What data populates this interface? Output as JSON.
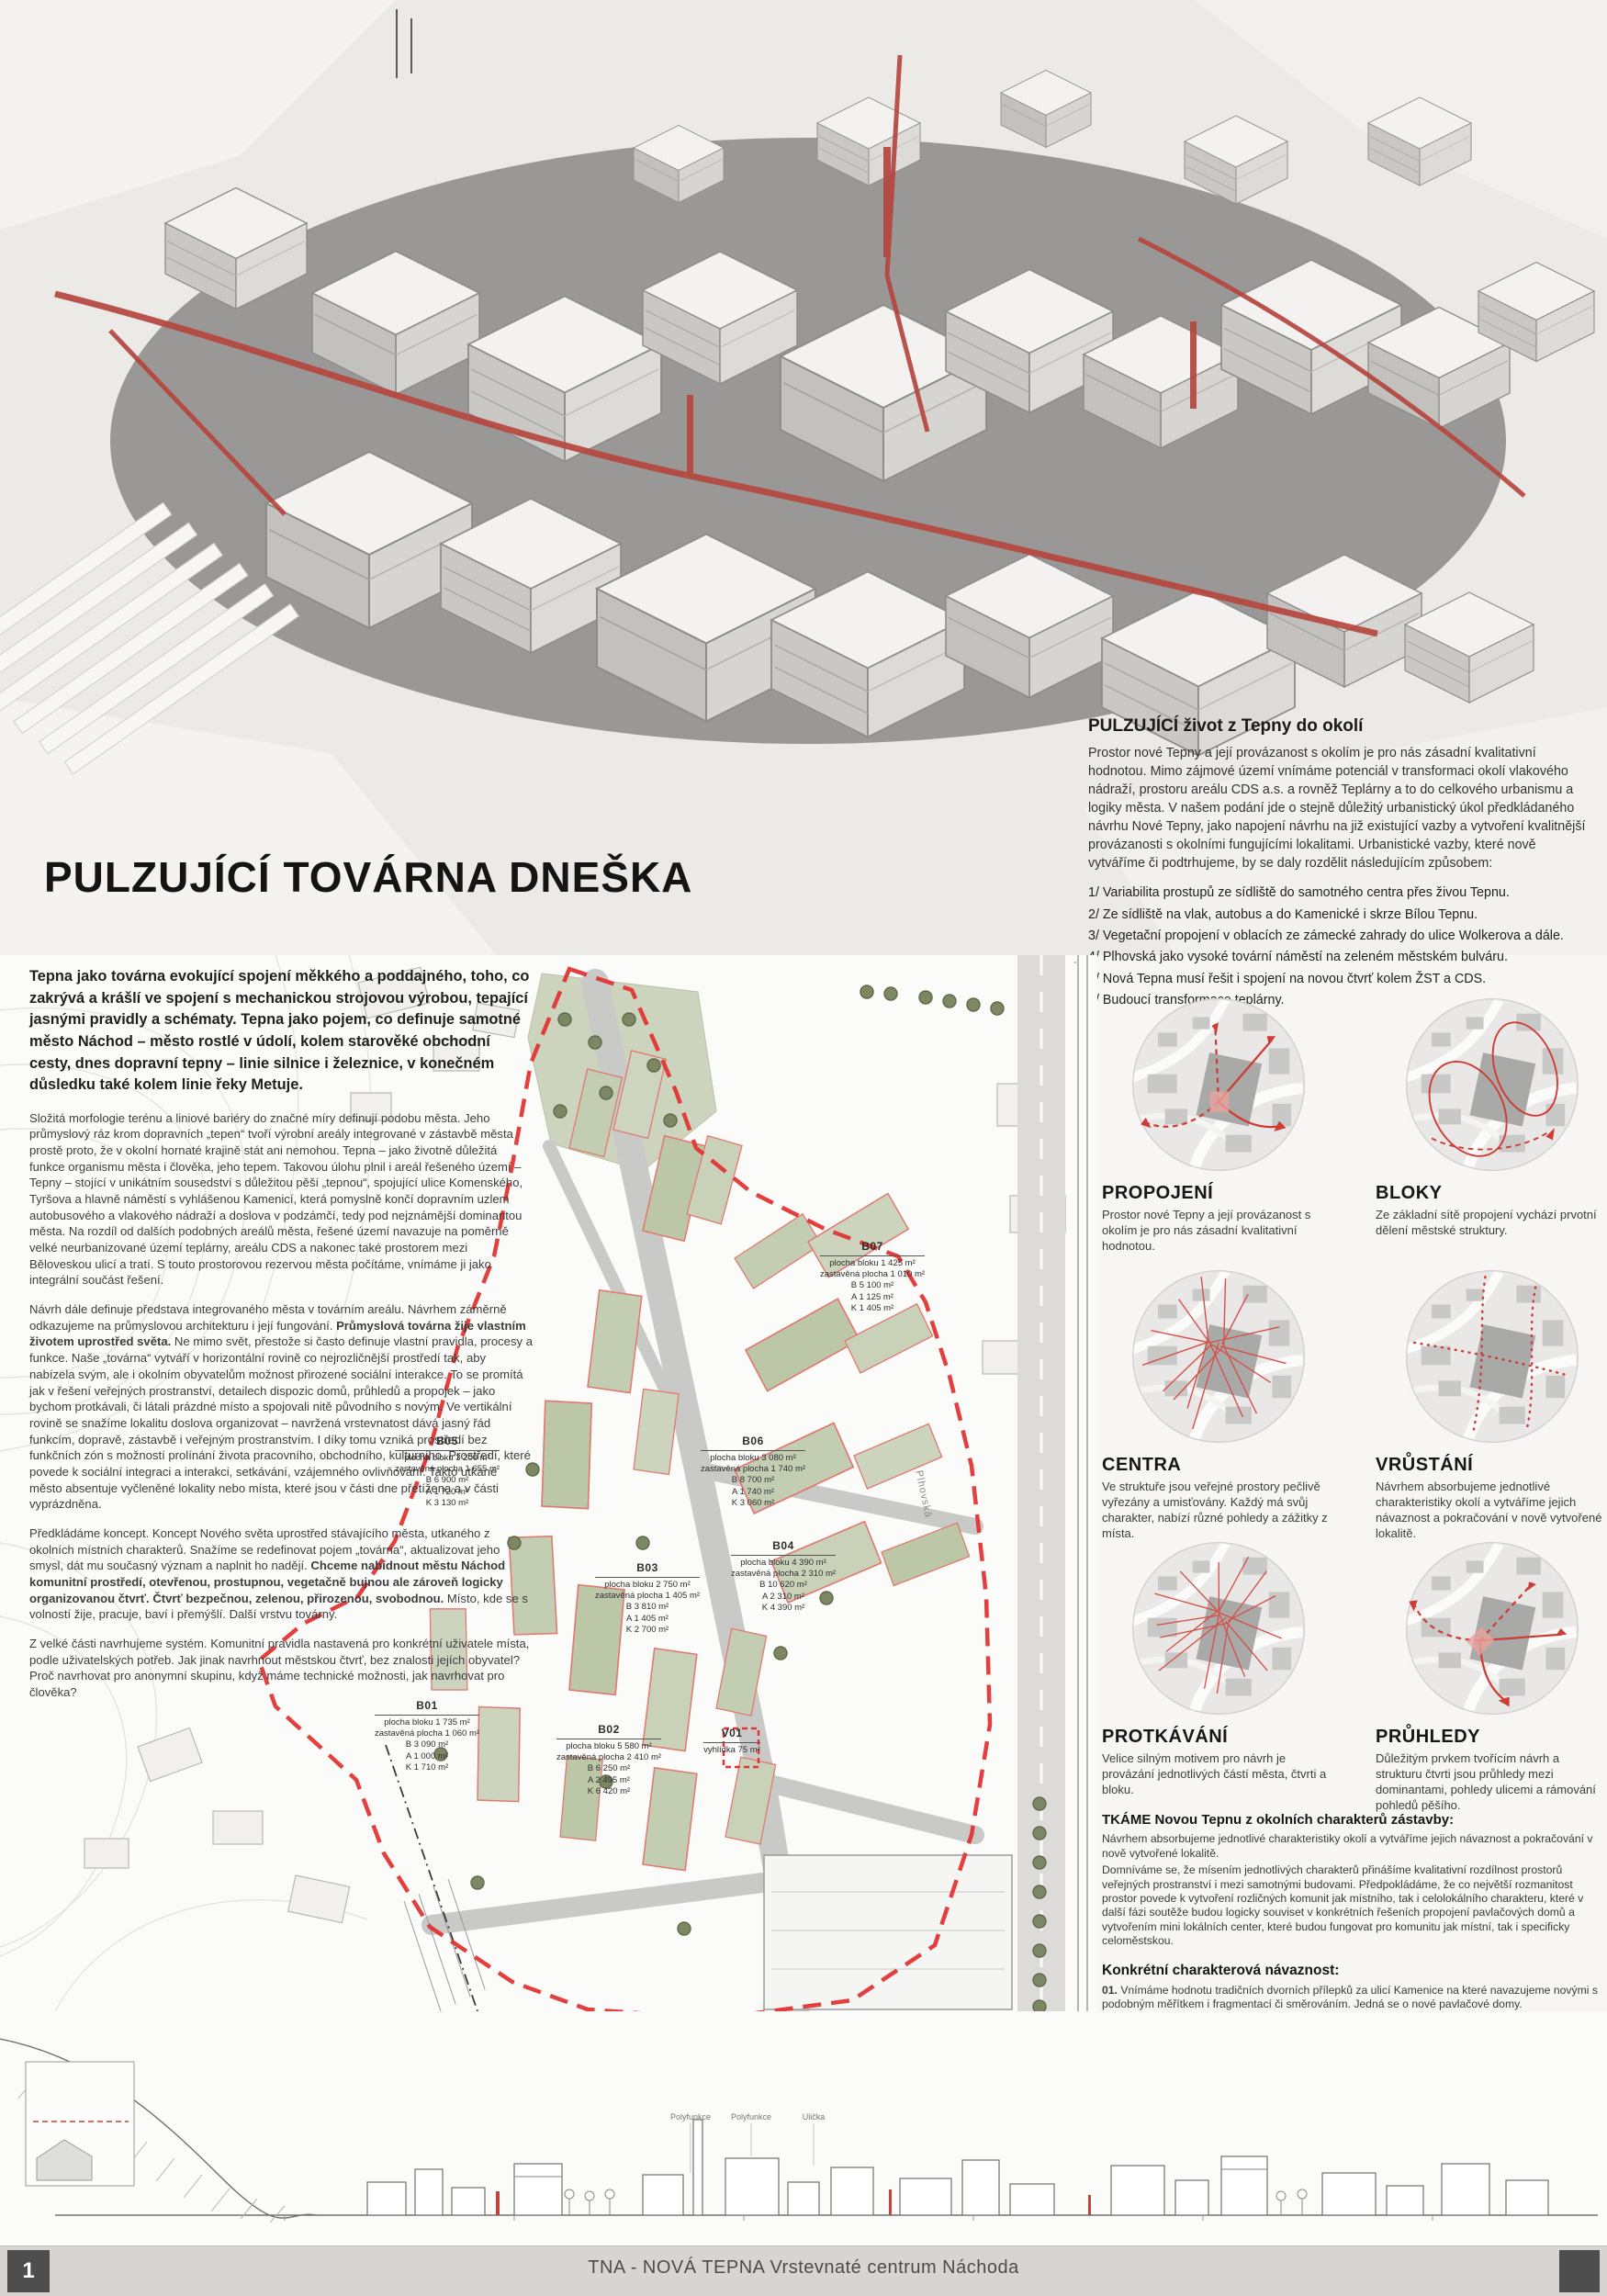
{
  "poster": {
    "title": "PULZUJÍCÍ TOVÁRNA DNEŠKA",
    "page_number": "1",
    "footer": "TNA - NOVÁ TEPNA Vrstevnaté centrum Náchoda"
  },
  "colors": {
    "accent_red": "#b5463f",
    "plan_red": "#e23535",
    "plan_green": "#c3cdb2",
    "footer_gray": "#d6d5d3"
  },
  "hero": {
    "heading": "PULZUJÍCÍ život z Tepny do okolí",
    "body": "Prostor nové Tepny a její provázanost s okolím je pro nás zásadní kvalitativní hodnotou. Mimo zájmové území vnímáme potenciál v transformaci okolí vlakového nádraží, prostoru areálu CDS a.s. a rovněž Teplárny a to do celkového urbanismu a logiky města. V našem podání jde o stejně důležitý urbanistický úkol předkládaného návrhu Nové Tepny, jako napojení návrhu na již existující vazby a vytvoření kvalitnější provázanosti s okolními fungujícími lokalitami. Urbanistické vazby, které nově vytváříme či podtrhujeme, by se daly rozdělit následujícím způsobem:",
    "list": [
      "1/ Variabilita prostupů ze sídliště do samotného centra přes živou Tepnu.",
      "2/ Ze sídliště na vlak, autobus a do Kamenické i skrze Bílou Tepnu.",
      "3/ Vegetační propojení v oblacích ze zámecké zahrady do ulice Wolkerova a dále.",
      "4/ Plhovská jako vysoké tovární náměstí na zeleném městském bulváru.",
      "5/ Nová Tepna musí řešit i spojení na novou čtvrť kolem ŽST a CDS.",
      "6/ Budoucí transformace teplárny."
    ]
  },
  "left_column": {
    "lead": "Tepna jako továrna evokující spojení měkkého a poddajného, toho, co zakrývá a krášlí ve spojení s mechanickou strojovou výrobou, tepající jasnými pravidly a schématy. Tepna jako pojem, co definuje samotné město Náchod – město rostlé v údolí, kolem starověké obchodní cesty, dnes dopravní tepny – linie silnice i železnice, v konečném důsledku také kolem linie řeky Metuje.",
    "p1": "Složitá morfologie terénu a liniové bariéry do značné míry definují podobu města. Jeho průmyslový ráz krom dopravních „tepen“ tvoří výrobní areály integrované v zástavbě města prostě proto, že v okolní hornaté krajině stát ani nemohou. Tepna – jako životně důležitá funkce organismu města i člověka, jeho tepem. Takovou úlohu plnil i areál řešeného území – Tepny – stojící v unikátním sousedství s důležitou pěší „tepnou“, spojující ulice Komenského, Tyršova a hlavně náměstí s vyhlášenou Kamenicí, která pomyslně končí dopravním uzlem autobusového a vlakového nádraží a doslova v podzámčí, tedy pod nejznámější dominantou města. Na rozdíl od dalších podobných areálů města, řešené území navazuje na poměrně velké neurbanizované území teplárny, areálu CDS a nakonec také prostorem mezi Běloveskou ulicí a tratí. S touto prostorovou rezervou města počítáme, vnímáme ji jako integrální součást řešení.",
    "p2a": "Návrh dále definuje představa integrovaného města v továrním areálu. Návrhem záměrně odkazujeme na průmyslovou architekturu i její fungování.",
    "p2b": "Průmyslová továrna žije vlastním životem uprostřed světa.",
    "p2c": "Ne mimo svět, přestože si často definuje vlastní pravidla, procesy a funkce. Naše „továrna“ vytváří v horizontální rovině co nejrozličnější prostředí tak, aby nabízela svým, ale i okolním obyvatelům možnost přirozené sociální interakce. To se promítá jak v řešení veřejných prostranství, detailech dispozic domů, průhledů a propojek – jako bychom protkávali, či látali prázdné místo a spojovali nitě původního s novým. Ve vertikální rovině se snažíme lokalitu doslova organizovat – navržená vrstevnatost dává jasný řád funkcím, dopravě, zástavbě i veřejným prostranstvím. I díky tomu vzniká prostředí bez funkčních zón s možností prolínání života pracovního, obchodního, kulturního. Prostředí, které povede k sociální integraci a interakci, setkávání, vzájemného ovlivňování. Takto utkané město absentuje vyčleněné lokality nebo místa, které jsou v části dne přetížena a v části vyprázdněna.",
    "p3a": "Předkládáme koncept. Koncept Nového světa uprostřed stávajícího města, utkaného z okolních místních charakterů. Snažíme se redefinovat pojem „továrna“, aktualizovat jeho smysl, dát mu současný význam a naplnit ho nadějí.",
    "p3b": "Chceme nabídnout městu Náchod komunitní prostředí, otevřenou, prostupnou, vegetačně bujnou ale zároveň logicky organizovanou čtvrť. Čtvrť bezpečnou, zelenou, přirozenou, svobodnou.",
    "p3c": "Místo, kde se s volností žije, pracuje, baví i přemýšlí. Další vrstvu továrny.",
    "p4": "Z velké části navrhujeme systém. Komunitní pravidla nastavená pro konkrétní uživatele místa, podle uživatelských potřeb. Jak jinak navrhnout městskou čtvrť, bez znalosti jejích obyvatel? Proč navrhovat pro anonymní skupinu, když máme technické možnosti, jak navrhovat pro člověka?"
  },
  "diagrams": [
    {
      "label": "PROPOJENÍ",
      "description": "Prostor nové Tepny a její provázanost s okolím je pro nás zásadní kvalitativní hodnotou."
    },
    {
      "label": "BLOKY",
      "description": "Ze základní sítě propojení vychází prvotní dělení městské struktury."
    },
    {
      "label": "CENTRA",
      "description": "Ve struktuře jsou veřejné prostory pečlivě vyřezány a umisťovány. Každý má svůj charakter, nabízí různé pohledy a zážitky z místa."
    },
    {
      "label": "VRŮSTÁNÍ",
      "description": "Návrhem absorbujeme jednotlivé charakteristiky okolí a vytváříme jejich návaznost a pokračování v nově vytvořené lokalitě."
    },
    {
      "label": "PROTKÁVÁNÍ",
      "description": "Velice silným motivem pro návrh je provázání jednotlivých částí města, čtvrti a bloku."
    },
    {
      "label": "PRŮHLEDY",
      "description": "Důležitým prvkem tvořícím návrh a strukturu čtvrti jsou průhledy mezi dominantami, pohledy ulicemi a rámování pohledů pěšího."
    }
  ],
  "tkame": {
    "heading": "TKÁME Novou Tepnu z okolních charakterů zástavby:",
    "p1": "Návrhem absorbujeme jednotlivé charakteristiky okolí a vytváříme jejich návaznost a pokračování v nově vytvořené lokalitě.",
    "p2": "Domníváme se, že mísením jednotlivých charakterů přinášíme kvalitativní rozdílnost prostorů veřejných prostranství i mezi samotnými budovami. Předpokládáme, že co největší rozmanitost prostor povede k vytvoření rozličných komunit jak místního, tak i celolokálního charakteru, které v další fázi soutěže budou logicky souviset v konkrétních řešeních propojení pavlačových domů a vytvořením mini lokálních center, které budou fungovat pro komunitu jak místní, tak i specificky celoměstskou.",
    "subheading": "Konkrétní charakterová návaznost:",
    "items": [
      {
        "num": "01.",
        "text": "Vnímáme hodnotu tradičních dvorních přílepků za ulicí Kamenice na které navazujeme novými s podobným měřítkem i fragmentací či směrováním. Jedná se o nové pavlačové domy."
      },
      {
        "num": "02.",
        "text": "Vnímáme rovněž dominanci a hodnotu Bílé tepny, kterou spolu s hmotou teplárny vtahujeme do tvarosloví a velikosti nových objektů na místě dnešního Lidlu. Rovněž dominanci komínů a charakteru továrny propouštíme skrze mnohé průhledy do nové čtvrti."
      },
      {
        "num": "03.",
        "text": "Reagujeme drobnějším fragmentovaným měřítkem na vilovou čtvrť pod zámkem"
      },
      {
        "num": "04.",
        "text": "Hlavní ulici vedoucí z historického jádra vizuálně navazujeme na tradiční vedení obchodních ulic historických měst a vytváříme tak charakterově podobnou ulici jako je ulice Kamenice."
      },
      {
        "num": "05.",
        "text": "Držíme se v okolí ulice Plhovské velikostí okolních továrních budov a jasně tak uzavíráme tento rozsáhlý městský bulvár."
      },
      {
        "num": "06.",
        "text": "Doplňujeme dům severně od panelového domu a uzavíráme jej novým blokem."
      }
    ],
    "closing": "Celý poměrně odlišný guláš urbanistických charakteristik spojujeme pomocí továrních úrovňových prostupů a bujnou vegetací. Vytváříme Vegetační tovární mix různých charakterů a živost. Rozmanitost je život."
  },
  "site_plan": {
    "street_label": "Plhovská",
    "blocks": [
      {
        "id": "B01",
        "info": "plocha bloku 1 735 m²\nzastavěná plocha 1 060 m²\nB 3 090 m²\nA 1 000 m²\nK 1 710 m²"
      },
      {
        "id": "B02",
        "info": "plocha bloku 5 580 m²\nzastavěná plocha 2 410 m²\nB 6 250 m²\nA 2 495 m²\nK 6 420 m²"
      },
      {
        "id": "B03",
        "info": "plocha bloku 2 750 m²\nzastavěná plocha 1 405 m²\nB 3 810 m²\nA 1 405 m²\nK 2 700 m²"
      },
      {
        "id": "B04",
        "info": "plocha bloku 4 390 m²\nzastavěná plocha 2 310 m²\nB 10 620 m²\nA 2 310 m²\nK 4 390 m²"
      },
      {
        "id": "B05",
        "info": "plocha bloku 3 200 m²\nzastavěná plocha 1 655 m²\nB 6 900 m²\nA 1 720 m²\nK 3 130 m²"
      },
      {
        "id": "B06",
        "info": "plocha bloku 3 080 m²\nzastavěná plocha 1 740 m²\nB 8 700 m²\nA 1 740 m²\nK 3 060 m²"
      },
      {
        "id": "B07",
        "info": "plocha bloku 1 425 m²\nzastavěná plocha 1 010 m²\nB 5 100 m²\nA 1 125 m²\nK 1 405 m²"
      },
      {
        "id": "V01",
        "info": "vyhlídka 75 m²"
      }
    ]
  },
  "section_drawing": {
    "labels": [
      "Polyfunkce",
      "Polyfunkce",
      "Ulička"
    ]
  }
}
